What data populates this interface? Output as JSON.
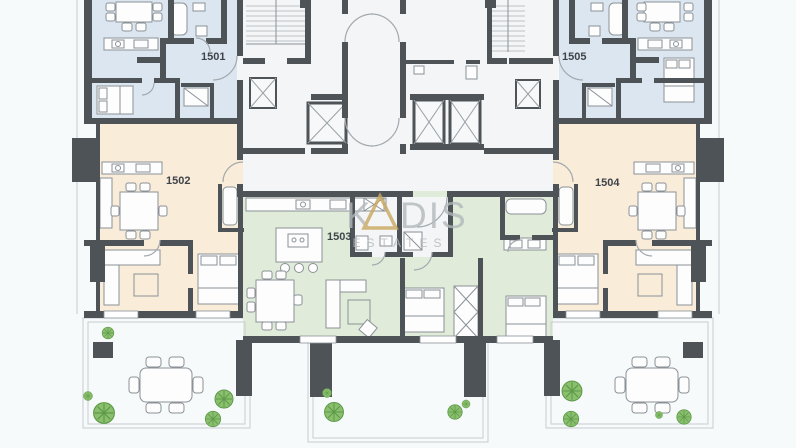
{
  "units": {
    "u1501": {
      "label": "1501"
    },
    "u1502": {
      "label": "1502"
    },
    "u1503": {
      "label": "1503"
    },
    "u1504": {
      "label": "1504"
    },
    "u1505": {
      "label": "1505"
    }
  },
  "watermark": {
    "k": "K",
    "dis": "DIS",
    "subtitle": "ESTATES"
  },
  "colors": {
    "bg": "#f7fafb",
    "wall": "#4e5357",
    "room": "#f3f5f7",
    "unit_blue": "#dce6f0",
    "unit_cream": "#f9ecd8",
    "unit_green": "#e0ecd9",
    "outline": "#c7ccd1",
    "furniture_stroke": "#8b9197",
    "furniture_fill": "#fdfdfe",
    "deck_stripe": "#e4e8eb",
    "plant_fill": "#8abf6e",
    "plant_stroke": "#5d9a48",
    "label_text": "#3f444a",
    "watermark_text": "#b3b8bc",
    "watermark_gold": "#c9a85d"
  }
}
